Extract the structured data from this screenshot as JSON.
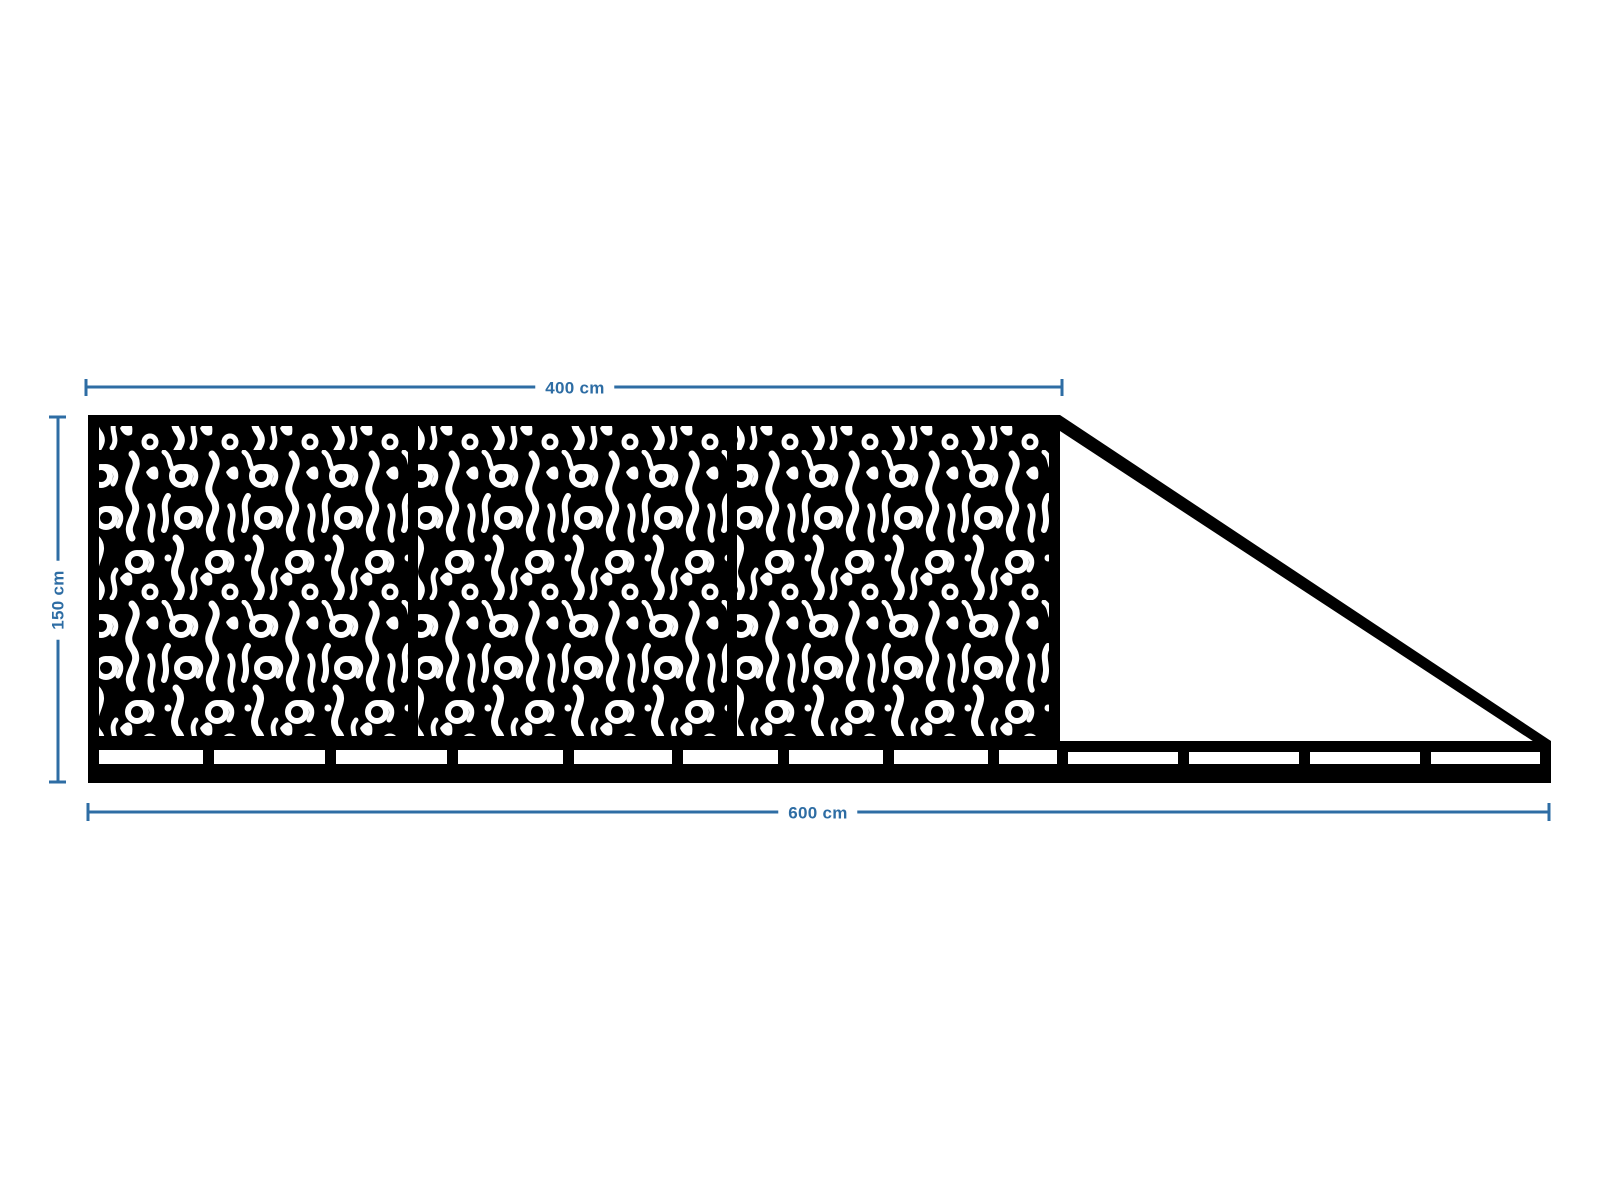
{
  "drawing": {
    "labels": {
      "panel_width": "400 cm",
      "height": "150 cm",
      "total_width": "600 cm"
    },
    "colors": {
      "dimension_line": "#2e6da4",
      "structure": "#000000",
      "background": "#ffffff"
    },
    "structure_info": {
      "ornament_panel_sections": "3",
      "has_diagonal_tail_brace": "true"
    }
  }
}
